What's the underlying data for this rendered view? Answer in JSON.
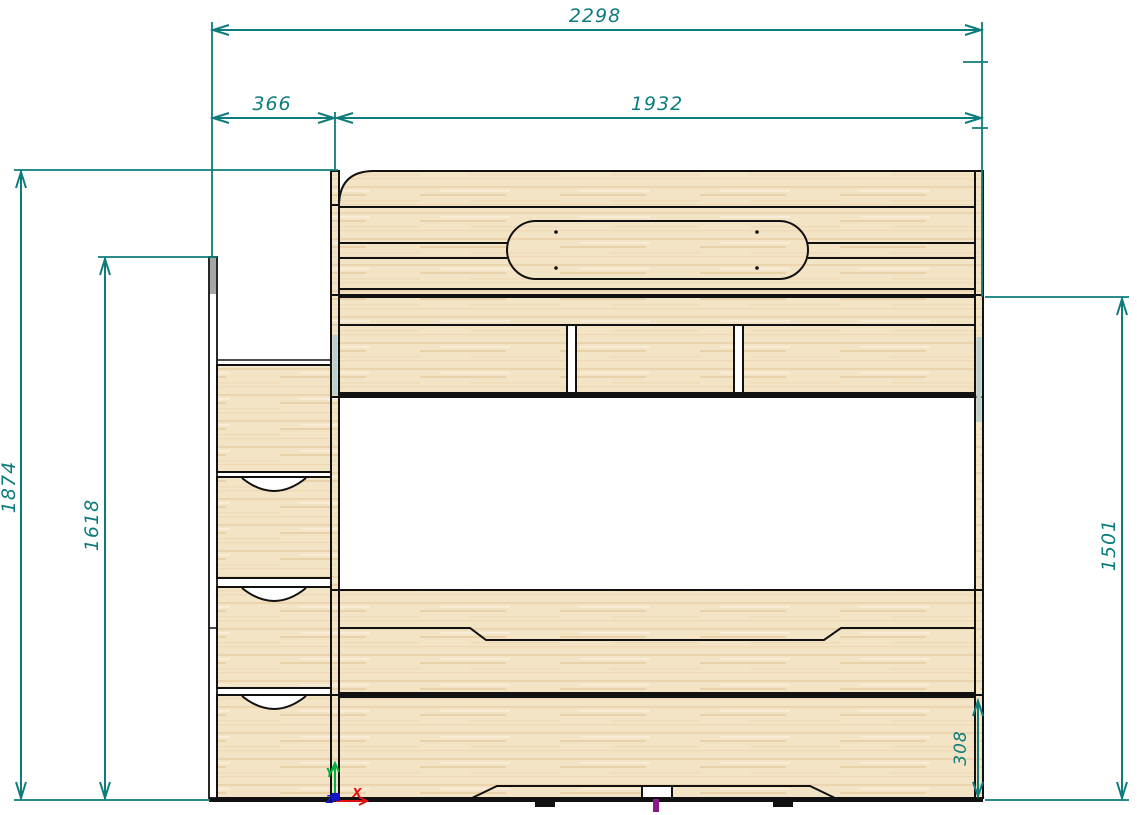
{
  "drawing": {
    "type": "furniture-front-elevation-cad",
    "subject": "bunk bed with ladder drawers, front view",
    "dimensions": {
      "overall_width": "2298",
      "ladder_width": "366",
      "bed_width": "1932",
      "overall_height": "1874",
      "ladder_height": "1618",
      "bed_side_height": "1501",
      "drawer_height": "308"
    },
    "axis_labels": {
      "x": "X",
      "y": "Y",
      "z": "Z"
    },
    "colors": {
      "dimension_line": "#0e7c7c",
      "outline": "#111111",
      "wood_fill": "#f4e4c6",
      "axis_x": "#e01010",
      "axis_y": "#00b33c",
      "axis_z": "#1717c9",
      "center_mark": "#8b1a8b",
      "background": "#ffffff"
    }
  }
}
